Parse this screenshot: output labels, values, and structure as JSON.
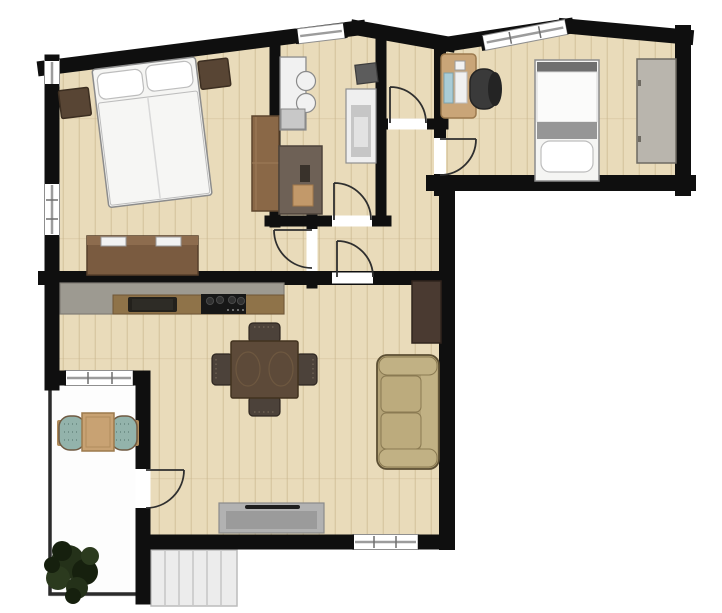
{
  "meta": {
    "type": "apartment-floor-plan",
    "canvas": {
      "width": 722,
      "height": 613
    }
  },
  "apartment": {
    "rooms": [
      {
        "name": "bedroom",
        "furniture": [
          "double-bed",
          "pillow",
          "pillow",
          "nightstand-left",
          "nightstand-right",
          "wardrobe",
          "dresser"
        ],
        "windows": 2,
        "doors": 1
      },
      {
        "name": "bathroom",
        "furniture": [
          "washbasin-vanity",
          "wall-cabinet",
          "shower",
          "bathroom-cabinet"
        ],
        "windows": 1,
        "doors": 1
      },
      {
        "name": "storage-room",
        "furniture": [],
        "windows": 0,
        "doors": 1
      },
      {
        "name": "office-bedroom",
        "furniture": [
          "desk",
          "office-chair",
          "single-bed",
          "wardrobe-gray"
        ],
        "windows": 1,
        "doors": 1
      },
      {
        "name": "hallway",
        "furniture": [],
        "windows": 0,
        "doors": 4
      },
      {
        "name": "living-room-kitchen",
        "furniture": [
          "kitchen-counter",
          "kitchen-sink",
          "cooktop",
          "dining-table",
          "dining-chair-north",
          "dining-chair-south",
          "dining-chair-west",
          "dining-chair-east",
          "sofa",
          "tv-board",
          "sideboard"
        ],
        "windows": 2,
        "doors": 2
      },
      {
        "name": "balcony",
        "outdoor": true,
        "furniture": [
          "bistro-table",
          "balcony-chair-left",
          "balcony-chair-right",
          "plant"
        ]
      },
      {
        "name": "exterior-stairs",
        "outdoor": true,
        "steps": 6
      }
    ],
    "door_count": 6,
    "window_count": 6
  },
  "palette": {
    "outside": "#ffffff",
    "wall": "#0f0f0f",
    "floor": "#e9dbba",
    "plank": "#c9b58c",
    "window_glass": "#ffffff",
    "window_frame": "#8f8f8f",
    "window_bar": "#9c9c9c",
    "window_tick": "#6f6f6f",
    "door_swing": "#2f2f2f",
    "threshold": "#ffffff",
    "balcony_floor": "#fdfdfd",
    "balcony_edge": "#e0e0e0",
    "railing": "#2b2b2b",
    "stairs_fill": "#ececec",
    "stairs_stroke": "#bcbcbc",
    "stairs_step": "#cfcfcf",
    "bed_linen": "#f5f5f3",
    "bed_sheet": "#fbfbfa",
    "bed_outline": "#8c8c8c",
    "pillow": "#ffffff",
    "pillow_outline": "#bdbdbd",
    "duvet": "#f6f6f4",
    "duvet_line": "#d8d8d8",
    "nightstand": "#584534",
    "nightstand_outline": "#3c2e21",
    "wardrobe_wood": "#8a6847",
    "wardrobe_wood_outline": "#5e462e",
    "wardrobe_wood_line": "#9d7b58",
    "dresser_wood": "#7a5b40",
    "dresser_top": "#8d6c4e",
    "dresser_outline": "#563f2a",
    "white_item": "#f2f2f2",
    "white_item_outline": "#9a9a9a",
    "fixture_base": "#dedede",
    "fixture_white": "#f1f1f1",
    "fixture_gray": "#c8c8c8",
    "fixture_outline": "#8a8a8a",
    "cabinet_dark": "#5c5c5c",
    "cabinet_dark_outline": "#3d3d3d",
    "shower_outer": "#efefef",
    "shower_inner": "#c6c6c6",
    "shower_core": "#e2e2e2",
    "taupe": "#6e6156",
    "taupe_outline": "#4d433a",
    "taupe_dark": "#39322b",
    "tan_mat": "#c2996a",
    "tan_mat_outline": "#a07749",
    "desk_wood": "#c9a578",
    "desk_outline": "#9c7a4e",
    "paper_blue": "#a9ccd6",
    "paper_blue_outline": "#7fa3ad",
    "paper_white": "#f0f0f0",
    "chair_black": "#3a3a3a",
    "chair_black_dark": "#242424",
    "headboard_gray": "#6f6f6f",
    "blanket_gray": "#969696",
    "wardrobe_gray": "#b9b5ad",
    "wardrobe_gray_outline": "#6e6a62",
    "counter_gray": "#9d9a91",
    "counter_outline": "#807d75",
    "counter_wood": "#8f7349",
    "counter_wood_outline": "#6f5635",
    "sink_black": "#23211c",
    "sink_inner": "#2e2c26",
    "cooktop_black": "#171717",
    "burner": "#303030",
    "burner_ring": "#4a4a4a",
    "burner_dot": "#8a8a8a",
    "table_wood": "#5d4a39",
    "table_outline": "#42321f",
    "table_grain": "#6e5840",
    "chair_wood": "#4c423a",
    "chair_outline": "#2e2620",
    "chair_dot": "#7d6f5d",
    "sofa_base": "#b3a276",
    "sofa_light": "#c1b184",
    "sofa_cushion": "#bcab7d",
    "sofa_outline": "#5c4f33",
    "sofa_inner_outline": "#8a7a52",
    "tv_board": "#4a3a31",
    "tv_outline": "#30241d",
    "sideboard": "#b2b2b2",
    "sideboard_inner": "#9b9b9b",
    "sideboard_outline": "#8b8b8b",
    "sideboard_dark": "#1e1e1e",
    "balcony_table": "#c8a273",
    "balcony_table_outline": "#9c7a4c",
    "balcony_table_inner": "#b08c5c",
    "chair_teal": "#93b3ab",
    "chair_teal_dot": "#50716a",
    "chair_arm": "#b08c5c",
    "chair_frame": "#6f5a42",
    "plant_dark": "#16200e",
    "plant_mid": "#243119",
    "plant_light": "#2b3a1e"
  }
}
